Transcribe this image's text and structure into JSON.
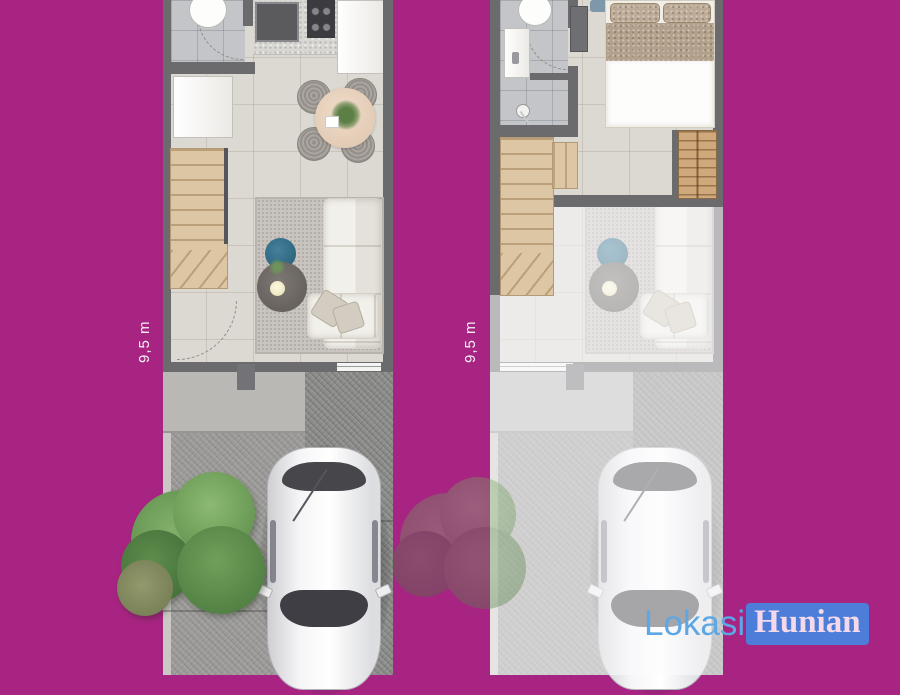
{
  "background_color": "#a82483",
  "watermark": {
    "part1": "Lokasi",
    "part2": "Hunian"
  },
  "plans": [
    {
      "name": "ground-floor-plan",
      "dimension_label": "9,5 m",
      "rooms": [
        "bathroom",
        "kitchen",
        "dining-area",
        "living-room",
        "stairs",
        "porch",
        "driveway"
      ],
      "furniture": [
        "toilet",
        "kitchen-sink",
        "stove",
        "refrigerator",
        "wardrobe",
        "dining-table",
        "dining-chairs",
        "sofa",
        "coffee-table",
        "side-table",
        "rug",
        "car",
        "tree"
      ]
    },
    {
      "name": "upper-floor-plan",
      "dimension_label": "9,5 m",
      "rooms": [
        "bathroom",
        "bedroom",
        "stairs",
        "ground-floor-view-faded"
      ],
      "furniture": [
        "toilet",
        "wash-basin",
        "shower",
        "double-bed",
        "cabinet",
        "dresser",
        "sofa",
        "rug",
        "car",
        "tree"
      ]
    }
  ],
  "colors": {
    "wall": "#6b6b6e",
    "floor": "#dcd8d2",
    "bath_floor": "#c3c5c8",
    "wood": "#dcc6a4",
    "driveway": "#9d9c9a",
    "driveway_dark": "#8d8d8b",
    "porch": "#b9b8b5",
    "rug": "#c9c4bf",
    "sofa": "#f2f0ea",
    "accent_table": "#35708a",
    "bed_blanket": "#b2a08b",
    "tree": "#6a9a55",
    "logo_blue": "#5ca7e4",
    "logo_box": "#4c7ed9",
    "logo_text": "#f5d9ea"
  }
}
